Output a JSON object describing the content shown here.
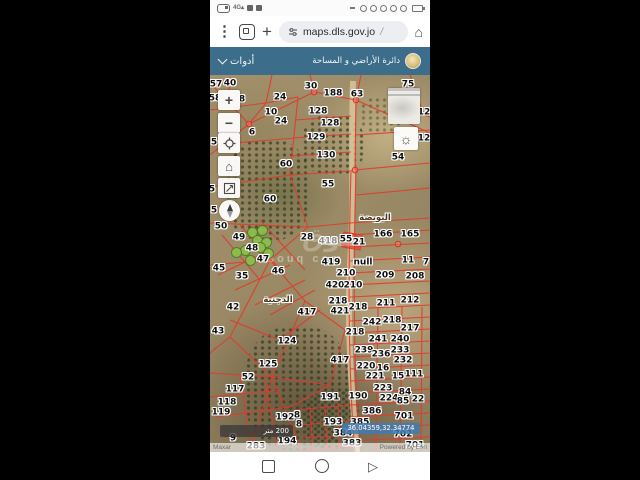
{
  "status_bar": {
    "right_dot_count": 5
  },
  "browser": {
    "url": "maps.dls.gov.jo",
    "url_suffix": "/"
  },
  "app_header": {
    "title": "دائرة الأراضي و المساحة",
    "tools_label": "أدوات"
  },
  "map": {
    "place_labels": [
      {
        "t": "البويضة",
        "x": 165,
        "y": 143
      },
      {
        "t": "الدجنية",
        "x": 68,
        "y": 225
      }
    ],
    "parcel_labels": [
      {
        "t": "57",
        "x": 6,
        "y": 10
      },
      {
        "t": "40",
        "x": 20,
        "y": 9
      },
      {
        "t": "30",
        "x": 101,
        "y": 12
      },
      {
        "t": "188",
        "x": 123,
        "y": 19
      },
      {
        "t": "63",
        "x": 147,
        "y": 20
      },
      {
        "t": "75",
        "x": 198,
        "y": 10
      },
      {
        "t": "58",
        "x": 5,
        "y": 24
      },
      {
        "t": "8",
        "x": 32,
        "y": 25
      },
      {
        "t": "24",
        "x": 70,
        "y": 23
      },
      {
        "t": "128",
        "x": 108,
        "y": 37
      },
      {
        "t": "10",
        "x": 61,
        "y": 38
      },
      {
        "t": "12",
        "x": 214,
        "y": 38
      },
      {
        "t": "24",
        "x": 71,
        "y": 47
      },
      {
        "t": "128",
        "x": 120,
        "y": 49
      },
      {
        "t": "6",
        "x": 42,
        "y": 58
      },
      {
        "t": "129",
        "x": 106,
        "y": 63
      },
      {
        "t": "5",
        "x": 4,
        "y": 68
      },
      {
        "t": "12",
        "x": 214,
        "y": 64
      },
      {
        "t": "130",
        "x": 116,
        "y": 81
      },
      {
        "t": "54",
        "x": 188,
        "y": 83
      },
      {
        "t": "60",
        "x": 76,
        "y": 90
      },
      {
        "t": "55",
        "x": 118,
        "y": 110
      },
      {
        "t": "5",
        "x": 2,
        "y": 115
      },
      {
        "t": "60",
        "x": 60,
        "y": 125
      },
      {
        "t": "5",
        "x": 4,
        "y": 136
      },
      {
        "t": "50",
        "x": 11,
        "y": 152
      },
      {
        "t": "49",
        "x": 29,
        "y": 163
      },
      {
        "t": "28",
        "x": 97,
        "y": 163
      },
      {
        "t": "418",
        "x": 118,
        "y": 167,
        "m": 1
      },
      {
        "t": "55",
        "x": 136,
        "y": 165
      },
      {
        "t": "21",
        "x": 149,
        "y": 168
      },
      {
        "t": "166",
        "x": 173,
        "y": 160
      },
      {
        "t": "165",
        "x": 200,
        "y": 160
      },
      {
        "t": "48",
        "x": 42,
        "y": 174
      },
      {
        "t": "47",
        "x": 53,
        "y": 185
      },
      {
        "t": "419",
        "x": 121,
        "y": 188
      },
      {
        "t": "null",
        "x": 153,
        "y": 188
      },
      {
        "t": "11",
        "x": 198,
        "y": 186
      },
      {
        "t": "7",
        "x": 216,
        "y": 188
      },
      {
        "t": "45",
        "x": 9,
        "y": 194
      },
      {
        "t": "35",
        "x": 32,
        "y": 202
      },
      {
        "t": "46",
        "x": 68,
        "y": 197
      },
      {
        "t": "210",
        "x": 136,
        "y": 199
      },
      {
        "t": "209",
        "x": 175,
        "y": 201
      },
      {
        "t": "208",
        "x": 205,
        "y": 202
      },
      {
        "t": "420",
        "x": 125,
        "y": 211
      },
      {
        "t": "210",
        "x": 143,
        "y": 211
      },
      {
        "t": "211",
        "x": 176,
        "y": 229
      },
      {
        "t": "212",
        "x": 200,
        "y": 226
      },
      {
        "t": "218",
        "x": 128,
        "y": 227
      },
      {
        "t": "42",
        "x": 23,
        "y": 233
      },
      {
        "t": "421",
        "x": 130,
        "y": 237
      },
      {
        "t": "218",
        "x": 148,
        "y": 233
      },
      {
        "t": "417",
        "x": 97,
        "y": 238
      },
      {
        "t": "242",
        "x": 162,
        "y": 248
      },
      {
        "t": "218",
        "x": 182,
        "y": 246
      },
      {
        "t": "217",
        "x": 200,
        "y": 254
      },
      {
        "t": "43",
        "x": 8,
        "y": 257
      },
      {
        "t": "218",
        "x": 145,
        "y": 258
      },
      {
        "t": "124",
        "x": 77,
        "y": 267
      },
      {
        "t": "241",
        "x": 168,
        "y": 265
      },
      {
        "t": "240",
        "x": 190,
        "y": 265
      },
      {
        "t": "239",
        "x": 154,
        "y": 276
      },
      {
        "t": "236",
        "x": 171,
        "y": 280
      },
      {
        "t": "233",
        "x": 190,
        "y": 276
      },
      {
        "t": "417",
        "x": 130,
        "y": 286
      },
      {
        "t": "232",
        "x": 193,
        "y": 286
      },
      {
        "t": "125",
        "x": 58,
        "y": 290
      },
      {
        "t": "220",
        "x": 156,
        "y": 292
      },
      {
        "t": "16",
        "x": 173,
        "y": 294
      },
      {
        "t": "221",
        "x": 165,
        "y": 302
      },
      {
        "t": "15",
        "x": 188,
        "y": 302
      },
      {
        "t": "111",
        "x": 204,
        "y": 300
      },
      {
        "t": "52",
        "x": 38,
        "y": 303
      },
      {
        "t": "117",
        "x": 25,
        "y": 315
      },
      {
        "t": "191",
        "x": 120,
        "y": 323
      },
      {
        "t": "190",
        "x": 148,
        "y": 322
      },
      {
        "t": "223",
        "x": 173,
        "y": 314
      },
      {
        "t": "84",
        "x": 195,
        "y": 318
      },
      {
        "t": "224",
        "x": 179,
        "y": 324
      },
      {
        "t": "85",
        "x": 193,
        "y": 327
      },
      {
        "t": "22",
        "x": 208,
        "y": 325
      },
      {
        "t": "118",
        "x": 17,
        "y": 328
      },
      {
        "t": "119",
        "x": 11,
        "y": 338
      },
      {
        "t": "192",
        "x": 75,
        "y": 343
      },
      {
        "t": "8",
        "x": 87,
        "y": 341
      },
      {
        "t": "8",
        "x": 89,
        "y": 350
      },
      {
        "t": "386",
        "x": 162,
        "y": 337
      },
      {
        "t": "701",
        "x": 194,
        "y": 342
      },
      {
        "t": "193",
        "x": 123,
        "y": 348
      },
      {
        "t": "385",
        "x": 150,
        "y": 348
      },
      {
        "t": "384",
        "x": 133,
        "y": 359
      },
      {
        "t": "702",
        "x": 193,
        "y": 360
      },
      {
        "t": "9",
        "x": 23,
        "y": 364
      },
      {
        "t": "194",
        "x": 77,
        "y": 367
      },
      {
        "t": "283",
        "x": 46,
        "y": 372
      },
      {
        "t": "383",
        "x": 142,
        "y": 369
      },
      {
        "t": "701",
        "x": 205,
        "y": 371
      }
    ],
    "green_markers": [
      {
        "x": 52,
        "y": 155
      },
      {
        "x": 42,
        "y": 157
      },
      {
        "x": 47,
        "y": 165
      },
      {
        "x": 56,
        "y": 167
      },
      {
        "x": 35,
        "y": 175
      },
      {
        "x": 26,
        "y": 177
      },
      {
        "x": 40,
        "y": 185
      },
      {
        "x": 50,
        "y": 172
      },
      {
        "x": 58,
        "y": 178
      }
    ],
    "watermark": {
      "arabic": "سوق",
      "latin": "souq com"
    },
    "controls": {
      "zoom_in": "+",
      "zoom_out": "−"
    },
    "scale_bar_label": "200 متر",
    "coordinates": "36.04359,32.34774",
    "attribution_left": "Maxar",
    "attribution_right": "Powered by Esri",
    "colors": {
      "parcel_line": "#e2392b",
      "header": "#3c6d8a",
      "coord_chip": "#427ab0",
      "marker_green": "#8bc34a"
    }
  }
}
